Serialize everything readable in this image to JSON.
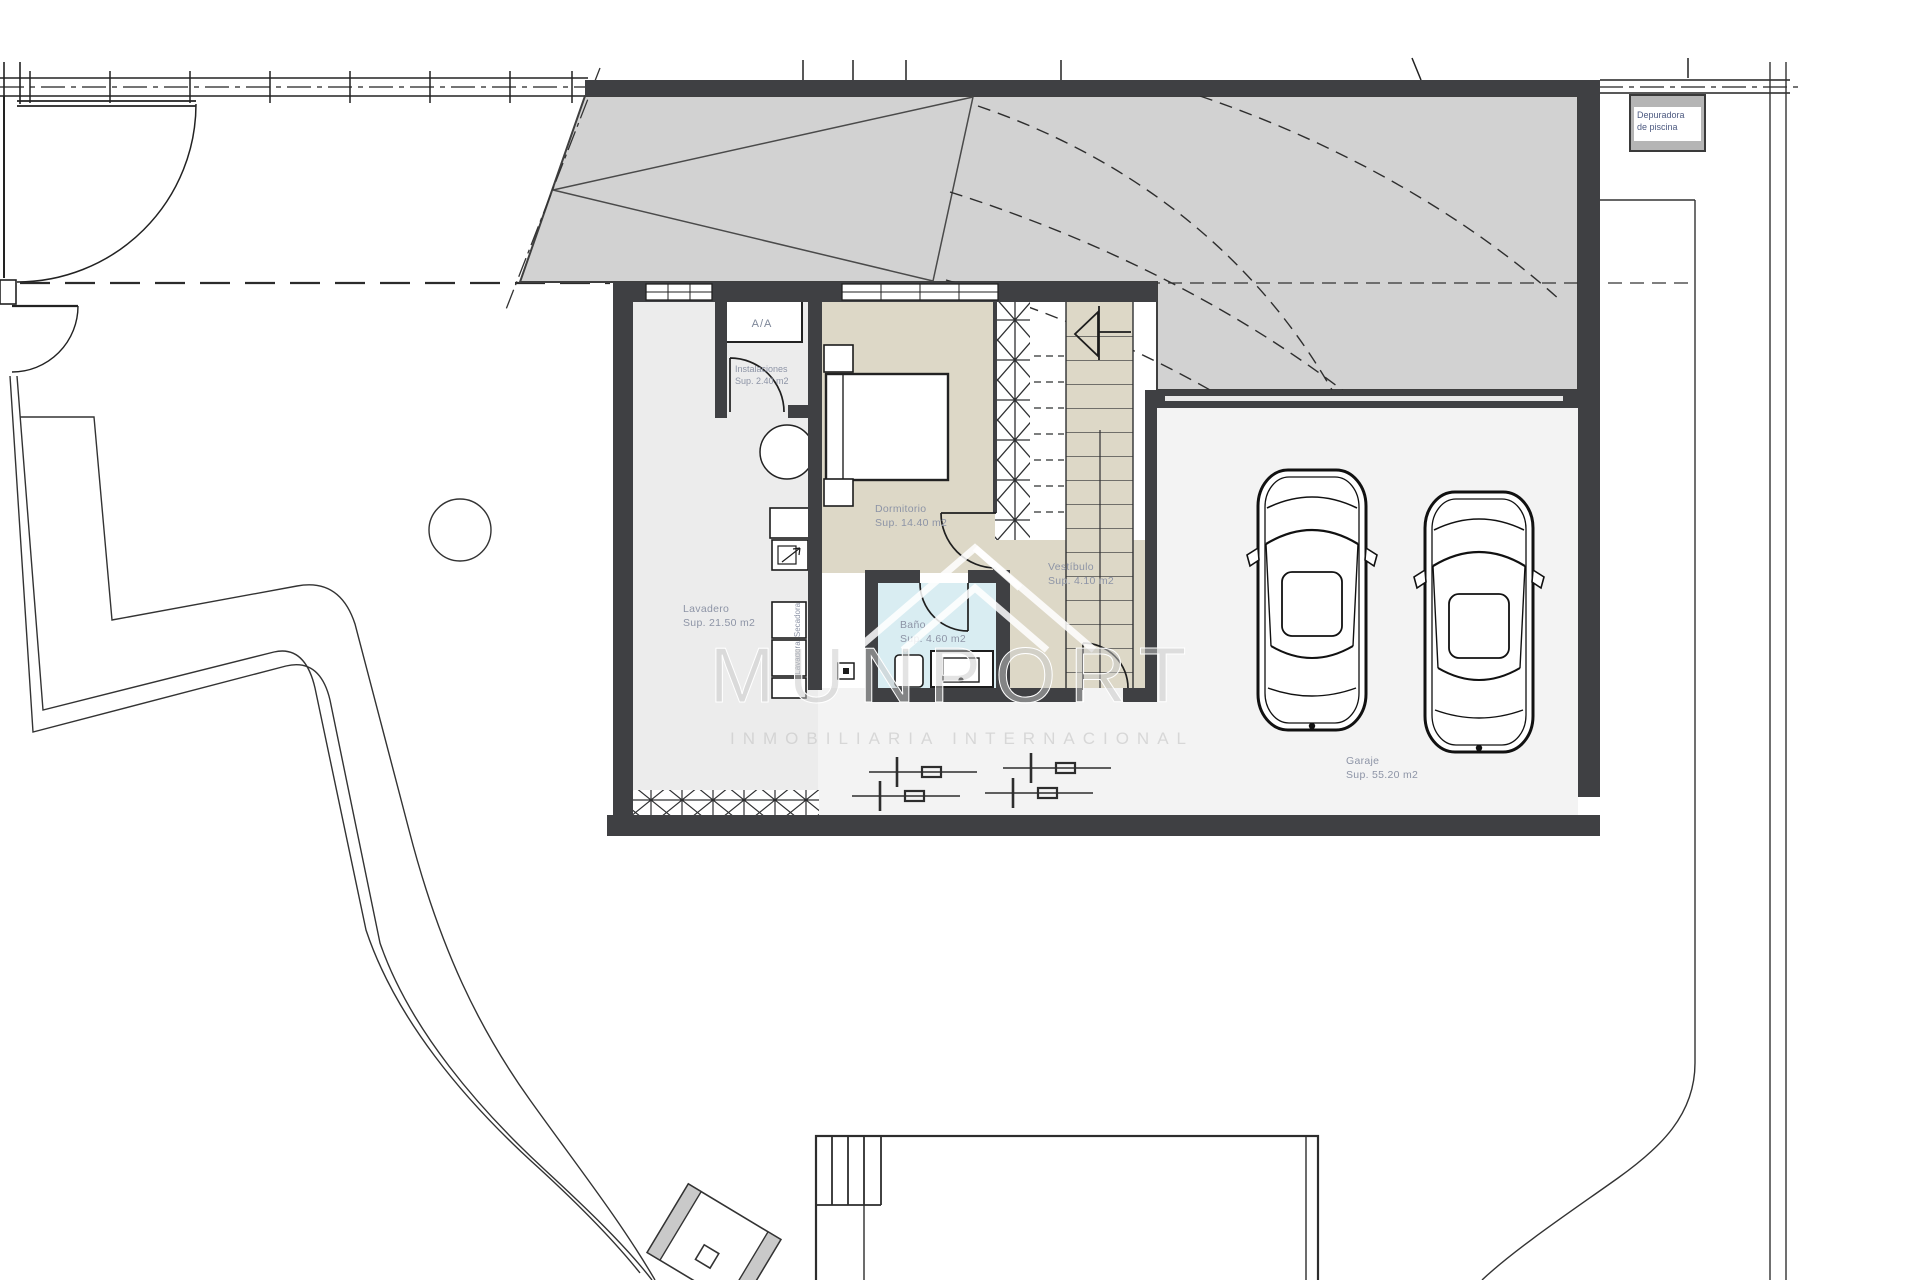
{
  "plan": {
    "rooms": {
      "instalaciones": {
        "name": "Instalaciones",
        "area": "Sup. 2.40 m2"
      },
      "dormitorio": {
        "name": "Dormitorio",
        "area": "Sup. 14.40 m2"
      },
      "lavadero": {
        "name": "Lavadero",
        "area": "Sup. 21.50 m2"
      },
      "bano": {
        "name": "Baño",
        "area": "Sup. 4.60 m2"
      },
      "vestibulo": {
        "name": "Vestíbulo",
        "area": "Sup. 4.10 m2"
      },
      "garaje": {
        "name": "Garaje",
        "area": "Sup. 55.20 m2"
      }
    },
    "labels": {
      "ac_unit": "A/A",
      "dryer": "Secadora",
      "washer": "Lavadora",
      "pool_equipment_line1": "Depuradora",
      "pool_equipment_line2": "de piscina"
    },
    "watermark": {
      "brand": "MUNPORT",
      "tagline": "INMOBILIARIA INTERNACIONAL"
    },
    "colors": {
      "wall": "#3f4043",
      "roof": "#d2d2d2",
      "bedroom_floor": "#ddd8c7",
      "bath_floor": "#d9edf2",
      "laundry_floor": "#ececec",
      "garage_floor": "#f3f3f3",
      "label_text": "#8d94a6",
      "equipment_text": "#4d5a80",
      "watermark": "#c8c8c8"
    }
  }
}
